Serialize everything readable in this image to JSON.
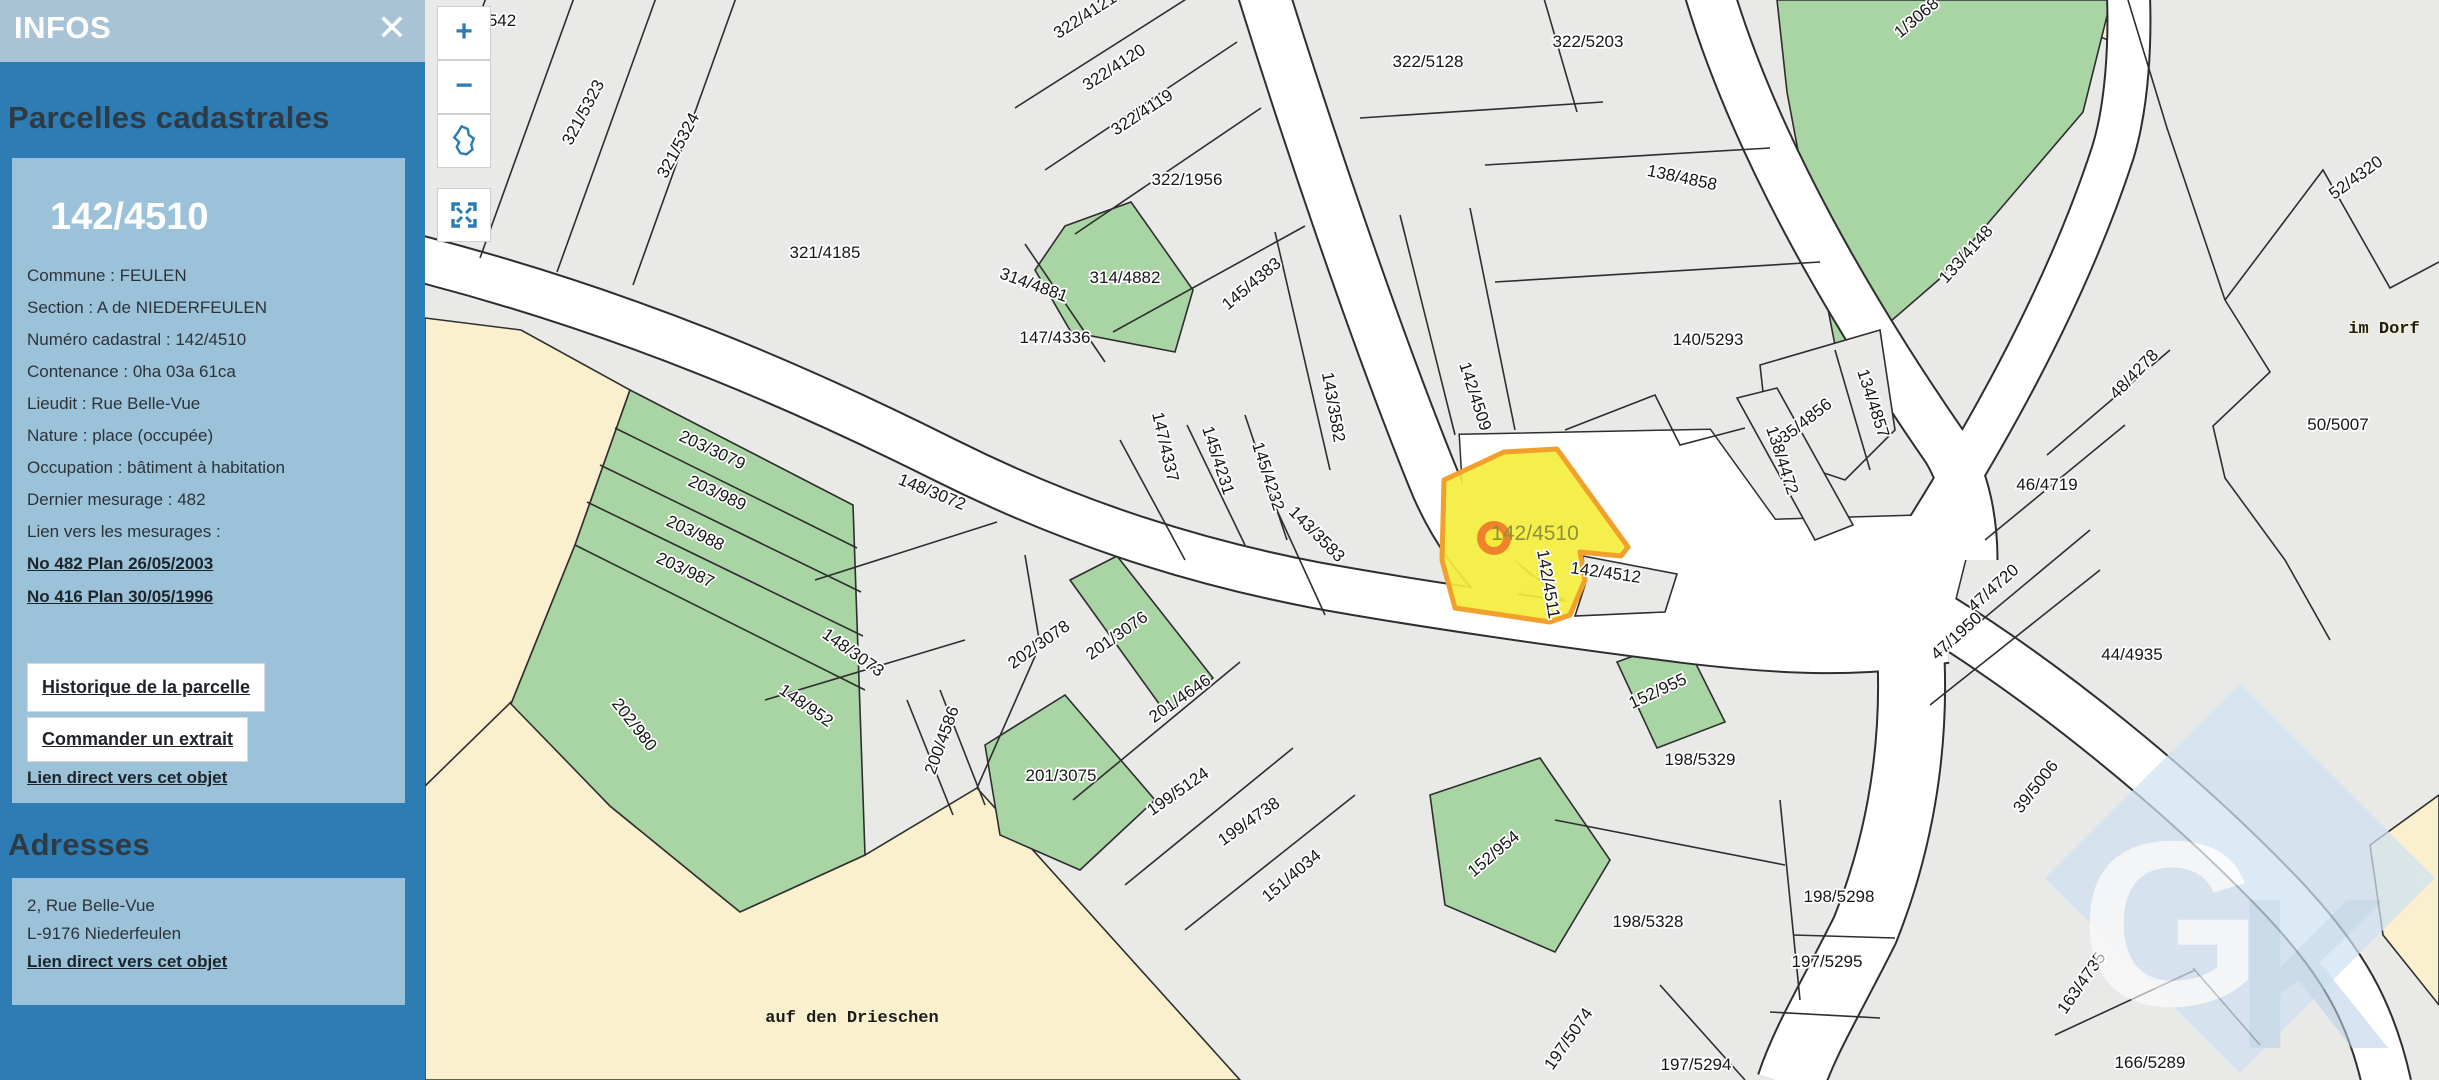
{
  "sidebar": {
    "header_title": "INFOS",
    "close_icon": "✕",
    "section1_heading": "Parcelles cadastrales",
    "parcel": {
      "number": "142/4510",
      "rows": [
        "Commune : FEULEN",
        "Section : A de NIEDERFEULEN",
        "Numéro cadastral : 142/4510",
        "Contenance : 0ha 03a 61ca",
        "Lieudit : Rue Belle-Vue",
        "Nature : place (occupée)",
        "Occupation : bâtiment à habitation",
        "Dernier mesurage : 482",
        "Lien vers les mesurages :"
      ],
      "mesurage_links": [
        "No 482 Plan 26/05/2003",
        "No 416 Plan 30/05/1996"
      ],
      "buttons": [
        "Historique de la parcelle",
        "Commander un extrait"
      ],
      "direct_link": "Lien direct vers cet objet"
    },
    "section2_heading": "Adresses",
    "address": {
      "lines": [
        "2, Rue Belle-Vue",
        "L-9176 Niederfeulen"
      ],
      "direct_link": "Lien direct vers cet objet"
    }
  },
  "map": {
    "controls": {
      "zoom_in": "+",
      "zoom_out": "−"
    },
    "selected_label": {
      "t": "142/4510",
      "x": 1110,
      "y": 540
    },
    "watermark": {
      "letter1": "G",
      "letter2": "K"
    },
    "colors": {
      "panel_blue": "#2e7cb4",
      "card_blue": "#9cc2d9",
      "header_blue": "#a7c3d5",
      "parcel_gray": "#e9e9e7",
      "green": "#a9d4a4",
      "beige": "#faf0cd",
      "selected_yellow": "#f4ee3e",
      "selected_orange": "#f2a02c",
      "road": "#ffffff"
    },
    "labels": [
      {
        "t": "542",
        "x": 77,
        "y": 26,
        "r": 0
      },
      {
        "t": "321/5323",
        "x": 163,
        "y": 115,
        "r": -62
      },
      {
        "t": "321/5324",
        "x": 258,
        "y": 148,
        "r": -62
      },
      {
        "t": "321/4185",
        "x": 400,
        "y": 258,
        "r": 0
      },
      {
        "t": "322/4121",
        "x": 663,
        "y": 20,
        "r": -33
      },
      {
        "t": "322/4120",
        "x": 692,
        "y": 72,
        "r": -33
      },
      {
        "t": "322/4119",
        "x": 720,
        "y": 117,
        "r": -33
      },
      {
        "t": "322/1956",
        "x": 762,
        "y": 185,
        "r": 0
      },
      {
        "t": "314/4881",
        "x": 607,
        "y": 290,
        "r": 20
      },
      {
        "t": "314/4882",
        "x": 700,
        "y": 283,
        "r": 0
      },
      {
        "t": "147/4336",
        "x": 630,
        "y": 343,
        "r": 0
      },
      {
        "t": "145/4383",
        "x": 830,
        "y": 288,
        "r": -40
      },
      {
        "t": "143/3582",
        "x": 903,
        "y": 408,
        "r": 80
      },
      {
        "t": "147/4337",
        "x": 735,
        "y": 448,
        "r": 77
      },
      {
        "t": "145/4231",
        "x": 788,
        "y": 462,
        "r": 72
      },
      {
        "t": "145/4232",
        "x": 838,
        "y": 478,
        "r": 72
      },
      {
        "t": "143/3583",
        "x": 888,
        "y": 538,
        "r": 45
      },
      {
        "t": "142/4509",
        "x": 1045,
        "y": 398,
        "r": 72
      },
      {
        "t": "322/5128",
        "x": 1003,
        "y": 67,
        "r": 0
      },
      {
        "t": "322/5203",
        "x": 1163,
        "y": 47,
        "r": 0
      },
      {
        "t": "138/4858",
        "x": 1256,
        "y": 183,
        "r": 12
      },
      {
        "t": "1/3068",
        "x": 1495,
        "y": 22,
        "r": -40
      },
      {
        "t": "133/4148",
        "x": 1545,
        "y": 258,
        "r": -48
      },
      {
        "t": "140/5293",
        "x": 1283,
        "y": 345,
        "r": 0
      },
      {
        "t": "135/4856",
        "x": 1380,
        "y": 428,
        "r": -38
      },
      {
        "t": "134/4857",
        "x": 1443,
        "y": 405,
        "r": 72
      },
      {
        "t": "138/4472",
        "x": 1352,
        "y": 462,
        "r": 72
      },
      {
        "t": "52/4320",
        "x": 1934,
        "y": 182,
        "r": -36
      },
      {
        "t": "im Dorf",
        "x": 1959,
        "y": 333,
        "r": 0,
        "k": "mono"
      },
      {
        "t": "48/4278",
        "x": 1713,
        "y": 378,
        "r": -46
      },
      {
        "t": "50/5007",
        "x": 1913,
        "y": 430,
        "r": 0
      },
      {
        "t": "46/4719",
        "x": 1622,
        "y": 490,
        "r": 0
      },
      {
        "t": "47/4720",
        "x": 1572,
        "y": 592,
        "r": -42
      },
      {
        "t": "47/1950",
        "x": 1535,
        "y": 640,
        "r": -42
      },
      {
        "t": "44/4935",
        "x": 1707,
        "y": 660,
        "r": 0
      },
      {
        "t": "39/5006",
        "x": 1615,
        "y": 790,
        "r": -52
      },
      {
        "t": "203/3079",
        "x": 285,
        "y": 455,
        "r": 25
      },
      {
        "t": "203/989",
        "x": 290,
        "y": 498,
        "r": 25
      },
      {
        "t": "203/988",
        "x": 268,
        "y": 538,
        "r": 25
      },
      {
        "t": "203/987",
        "x": 258,
        "y": 575,
        "r": 25
      },
      {
        "t": "202/980",
        "x": 205,
        "y": 728,
        "r": 52
      },
      {
        "t": "148/3072",
        "x": 505,
        "y": 497,
        "r": 22
      },
      {
        "t": "148/3073",
        "x": 425,
        "y": 657,
        "r": 35
      },
      {
        "t": "148/952",
        "x": 378,
        "y": 710,
        "r": 35
      },
      {
        "t": "200/4586",
        "x": 522,
        "y": 742,
        "r": -70
      },
      {
        "t": "202/3078",
        "x": 617,
        "y": 649,
        "r": -35
      },
      {
        "t": "201/3076",
        "x": 695,
        "y": 640,
        "r": -35
      },
      {
        "t": "201/4646",
        "x": 758,
        "y": 703,
        "r": -35
      },
      {
        "t": "201/3075",
        "x": 636,
        "y": 781,
        "r": 0
      },
      {
        "t": "199/5124",
        "x": 756,
        "y": 796,
        "r": -35
      },
      {
        "t": "199/4738",
        "x": 827,
        "y": 826,
        "r": -35
      },
      {
        "t": "151/4034",
        "x": 870,
        "y": 880,
        "r": -40
      },
      {
        "t": "152/954",
        "x": 1072,
        "y": 858,
        "r": -40
      },
      {
        "t": "152/955",
        "x": 1235,
        "y": 696,
        "r": -25
      },
      {
        "t": "142/4511",
        "x": 1118,
        "y": 585,
        "r": 80
      },
      {
        "t": "142/4512",
        "x": 1180,
        "y": 578,
        "r": 8
      },
      {
        "t": "198/5329",
        "x": 1275,
        "y": 765,
        "r": 0
      },
      {
        "t": "198/5328",
        "x": 1223,
        "y": 927,
        "r": 0
      },
      {
        "t": "198/5298",
        "x": 1414,
        "y": 902,
        "r": 0
      },
      {
        "t": "197/5295",
        "x": 1402,
        "y": 967,
        "r": 0
      },
      {
        "t": "197/5074",
        "x": 1148,
        "y": 1042,
        "r": -55
      },
      {
        "t": "197/5294",
        "x": 1271,
        "y": 1070,
        "r": 0
      },
      {
        "t": "163/4735",
        "x": 1661,
        "y": 986,
        "r": -55
      },
      {
        "t": "166/5289",
        "x": 1725,
        "y": 1068,
        "r": 0
      },
      {
        "t": "auf den Drieschen",
        "x": 427,
        "y": 1022,
        "r": 0,
        "k": "mono"
      }
    ]
  }
}
